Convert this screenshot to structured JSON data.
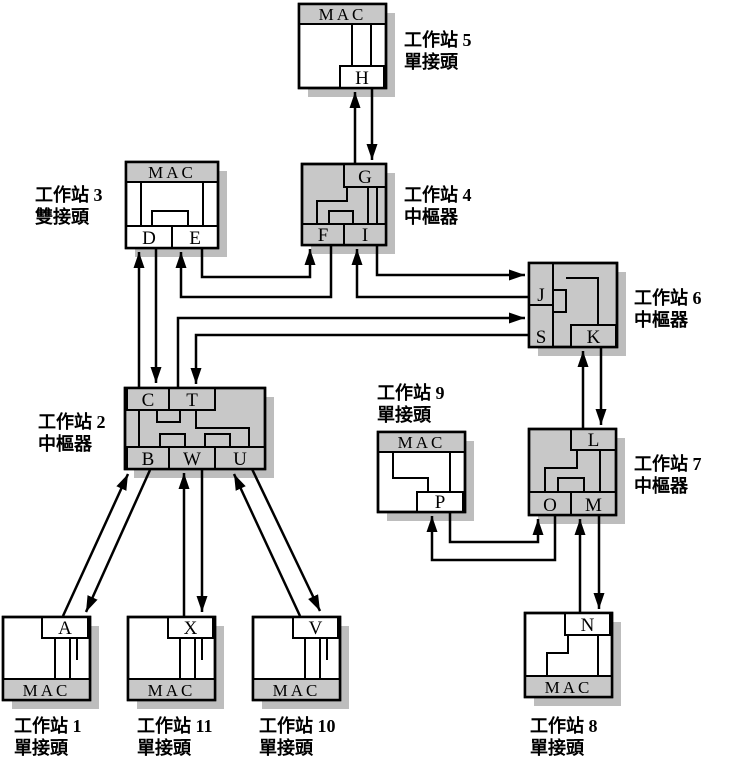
{
  "figure": {
    "kind": "fddi-network-topology-diagram",
    "background": "#ffffff",
    "colors": {
      "box_gray": "#c8c8c8",
      "shadow_gray": "#bdbdbd",
      "white_fill": "#ffffff",
      "line_black": "#000000"
    },
    "stations": [
      {
        "id": "ws5",
        "name": "工作站 5",
        "type_label": "單接頭",
        "mac_label": "MAC",
        "ports": [
          "H"
        ]
      },
      {
        "id": "ws3",
        "name": "工作站 3",
        "type_label": "雙接頭",
        "mac_label": "MAC",
        "ports": [
          "D",
          "E"
        ]
      },
      {
        "id": "ws4",
        "name": "工作站 4",
        "type_label": "中樞器",
        "ports": [
          "G",
          "F",
          "I"
        ]
      },
      {
        "id": "ws6",
        "name": "工作站 6",
        "type_label": "中樞器",
        "ports": [
          "J",
          "S",
          "K"
        ]
      },
      {
        "id": "ws2",
        "name": "工作站 2",
        "type_label": "中樞器",
        "ports": [
          "C",
          "T",
          "B",
          "W",
          "U"
        ]
      },
      {
        "id": "ws9",
        "name": "工作站 9",
        "type_label": "單接頭",
        "mac_label": "MAC",
        "ports": [
          "P"
        ]
      },
      {
        "id": "ws7",
        "name": "工作站 7",
        "type_label": "中樞器",
        "ports": [
          "L",
          "O",
          "M"
        ]
      },
      {
        "id": "ws1",
        "name": "工作站 1",
        "type_label": "單接頭",
        "mac_label": "MAC",
        "ports": [
          "A"
        ]
      },
      {
        "id": "ws11",
        "name": "工作站 11",
        "type_label": "單接頭",
        "mac_label": "MAC",
        "ports": [
          "X"
        ]
      },
      {
        "id": "ws10",
        "name": "工作站 10",
        "type_label": "單接頭",
        "mac_label": "MAC",
        "ports": [
          "V"
        ]
      },
      {
        "id": "ws8",
        "name": "工作站 8",
        "type_label": "單接頭",
        "mac_label": "MAC",
        "ports": [
          "N"
        ]
      }
    ],
    "connections": [
      {
        "from": "G",
        "to": "H"
      },
      {
        "from": "H",
        "to": "G"
      },
      {
        "from": "C",
        "to": "D"
      },
      {
        "from": "D",
        "to": "C"
      },
      {
        "from": "E",
        "to": "F"
      },
      {
        "from": "F",
        "to": "E"
      },
      {
        "from": "I",
        "to": "J"
      },
      {
        "from": "J",
        "to": "I"
      },
      {
        "from": "T",
        "to": "S"
      },
      {
        "from": "S",
        "to": "T"
      },
      {
        "from": "L",
        "to": "K"
      },
      {
        "from": "K",
        "to": "L"
      },
      {
        "from": "P",
        "to": "O"
      },
      {
        "from": "O",
        "to": "P"
      },
      {
        "from": "N",
        "to": "M"
      },
      {
        "from": "M",
        "to": "N"
      },
      {
        "from": "A",
        "to": "B"
      },
      {
        "from": "B",
        "to": "A"
      },
      {
        "from": "X",
        "to": "W"
      },
      {
        "from": "W",
        "to": "X"
      },
      {
        "from": "V",
        "to": "U"
      },
      {
        "from": "U",
        "to": "V"
      }
    ]
  }
}
